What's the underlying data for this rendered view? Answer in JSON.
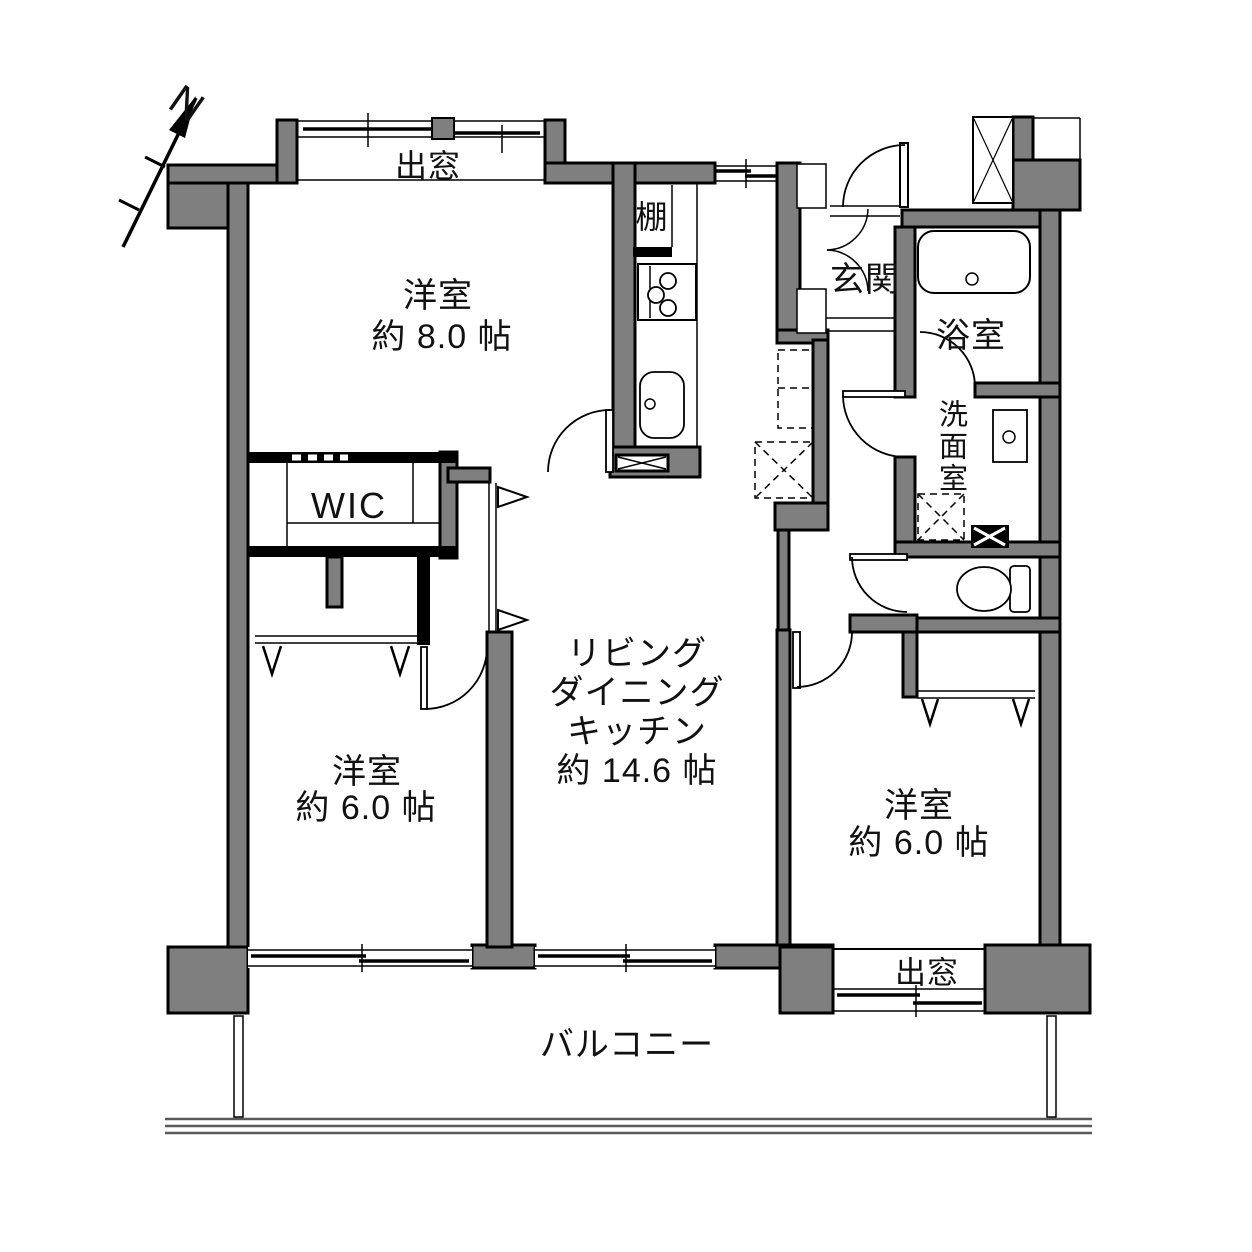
{
  "floor_plan": {
    "compass_label": "N",
    "labels": {
      "bay_window_north": "出窓",
      "bay_window_south": "出窓",
      "shelf": "棚",
      "entrance": "玄関",
      "bathroom": "浴室",
      "washroom": "洗面室",
      "wic": "WIC",
      "balcony": "バルコニー"
    },
    "rooms": {
      "bedroom_nw": {
        "name": "洋室",
        "size": "約 8.0 帖"
      },
      "bedroom_sw": {
        "name": "洋室",
        "size": "約 6.0 帖"
      },
      "bedroom_se": {
        "name": "洋室",
        "size": "約 6.0 帖"
      },
      "ldk": {
        "line1": "リビング",
        "line2": "ダイニング",
        "line3": "キッチン",
        "size": "約 14.6 帖"
      }
    },
    "colors": {
      "wall_fill": "#7f7f7f",
      "line": "#000000",
      "background": "#ffffff"
    }
  }
}
